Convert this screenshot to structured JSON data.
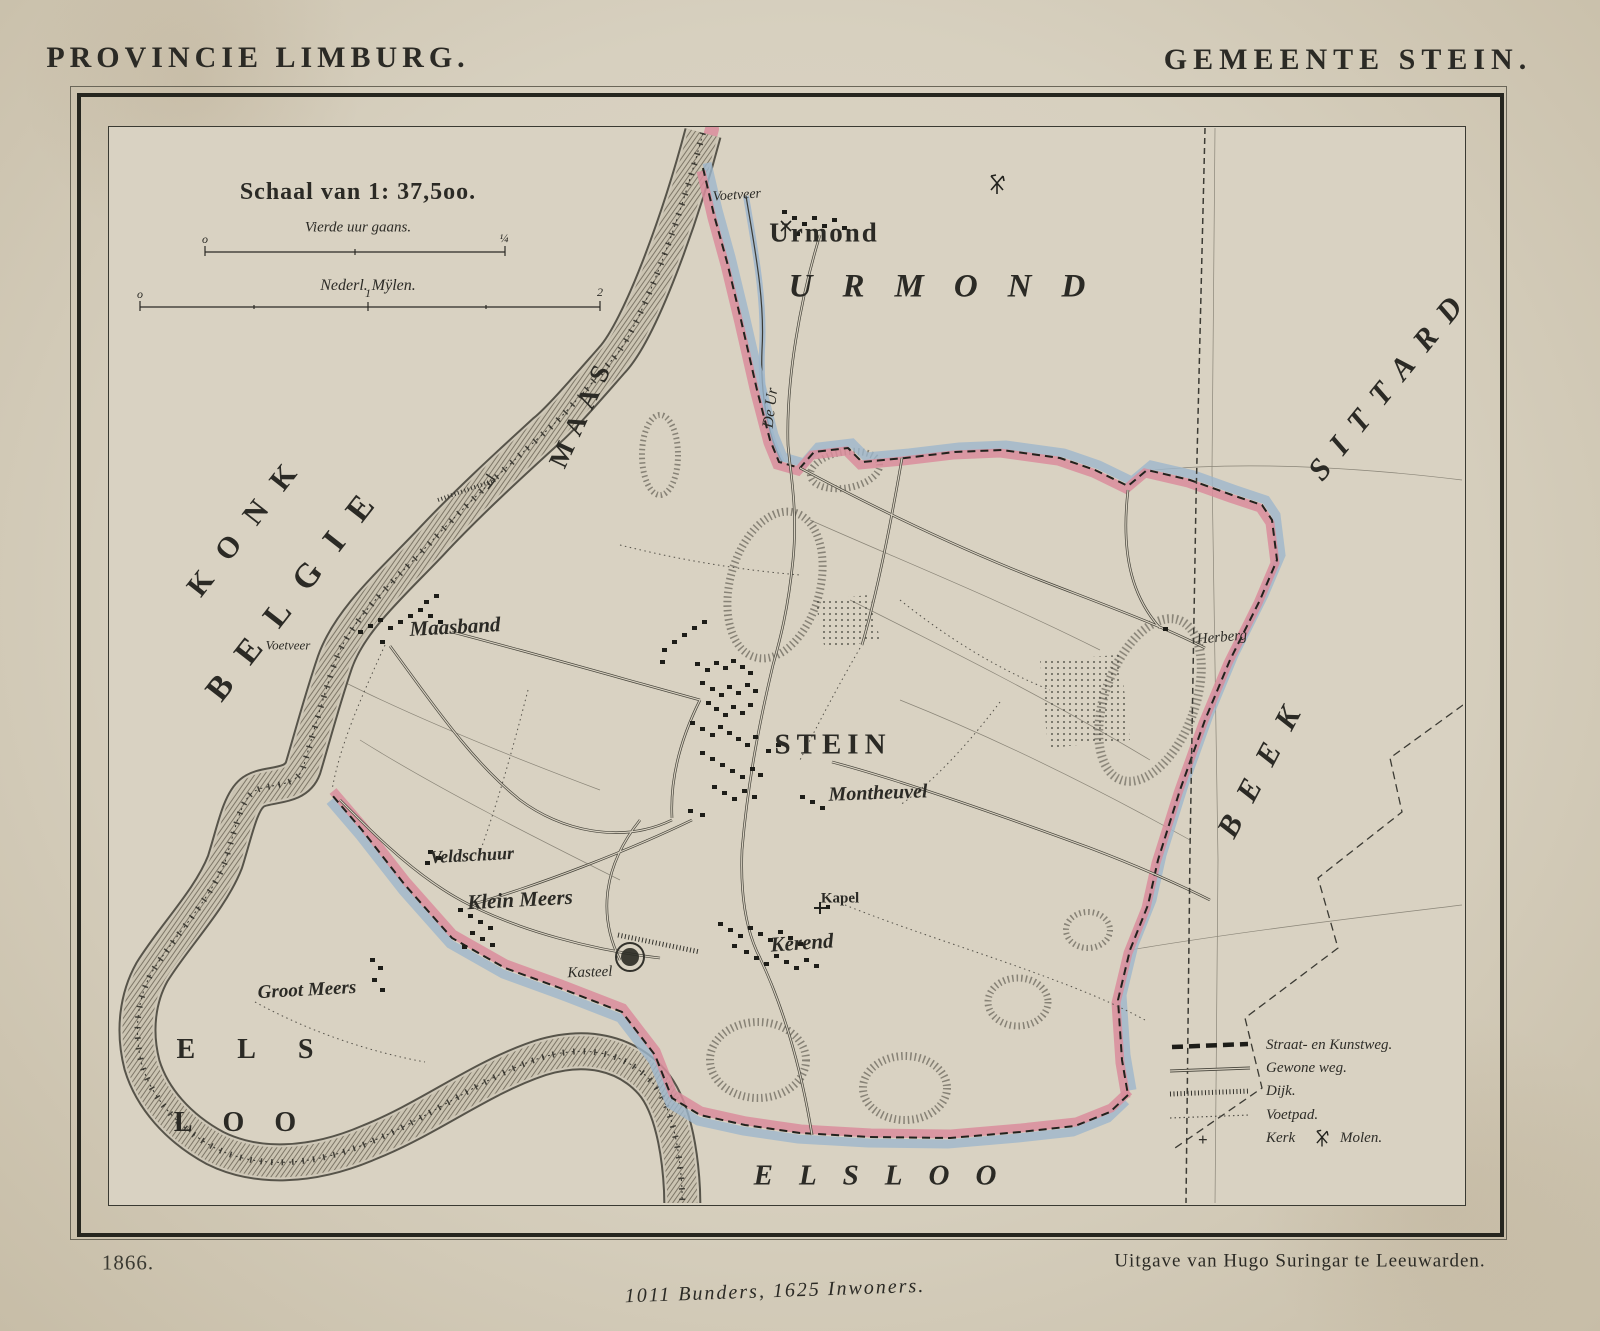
{
  "page": {
    "title_left": "PROVINCIE LIMBURG.",
    "title_right": "GEMEENTE STEIN.",
    "year": "1866.",
    "publisher": "Uitgave van Hugo Suringar te Leeuwarden.",
    "statistics": "1011 Bunders, 1625 Inwoners."
  },
  "scale": {
    "heading": "Schaal van 1: 37,5oo.",
    "bar1_label": "Vierde uur gaans.",
    "bar1_start": "o",
    "bar1_end": "¼",
    "bar2_label": "Nederl. Mÿlen.",
    "bar2_start": "o",
    "bar2_mid": "1",
    "bar2_end": "2"
  },
  "legend": {
    "items": [
      {
        "label": "Straat- en Kunstweg."
      },
      {
        "label": "Gewone weg."
      },
      {
        "label": "Dijk."
      },
      {
        "label": "Voetpad."
      },
      {
        "prefix": "+",
        "label_a": "Kerk",
        "label_b": "Molen."
      }
    ]
  },
  "map": {
    "labels": {
      "urmond_village": "Urmond",
      "urmond_region": "URMOND",
      "sittard_region": "SITTARD",
      "beek_region": "BEEK",
      "belgie_region": "BELGIE",
      "konk_region": "KONK",
      "maas_river": "MAAS",
      "de_ur_stream": "De Ur",
      "voetveer_north": "Voetveer",
      "voetveer_west": "Voetveer",
      "maasband": "Maasband",
      "stein": "STEIN",
      "montheuvel": "Montheuvel",
      "veldschuur": "Veldschuur",
      "klein_meers": "Klein Meers",
      "kasteel": "Kasteel",
      "groot_meers": "Groot Meers",
      "kapel": "Kapel",
      "kerend": "Kerend",
      "herberg": "Herberg",
      "els": "ELS",
      "loo": "LOO",
      "elsloo": "ELSLOO"
    }
  },
  "colors": {
    "paper": "#d8d1c1",
    "ink": "#2b2a25",
    "maas_yellow": "#e4c73e",
    "boundary_pink": "#d98d9c",
    "boundary_blue": "#9db6cc"
  }
}
